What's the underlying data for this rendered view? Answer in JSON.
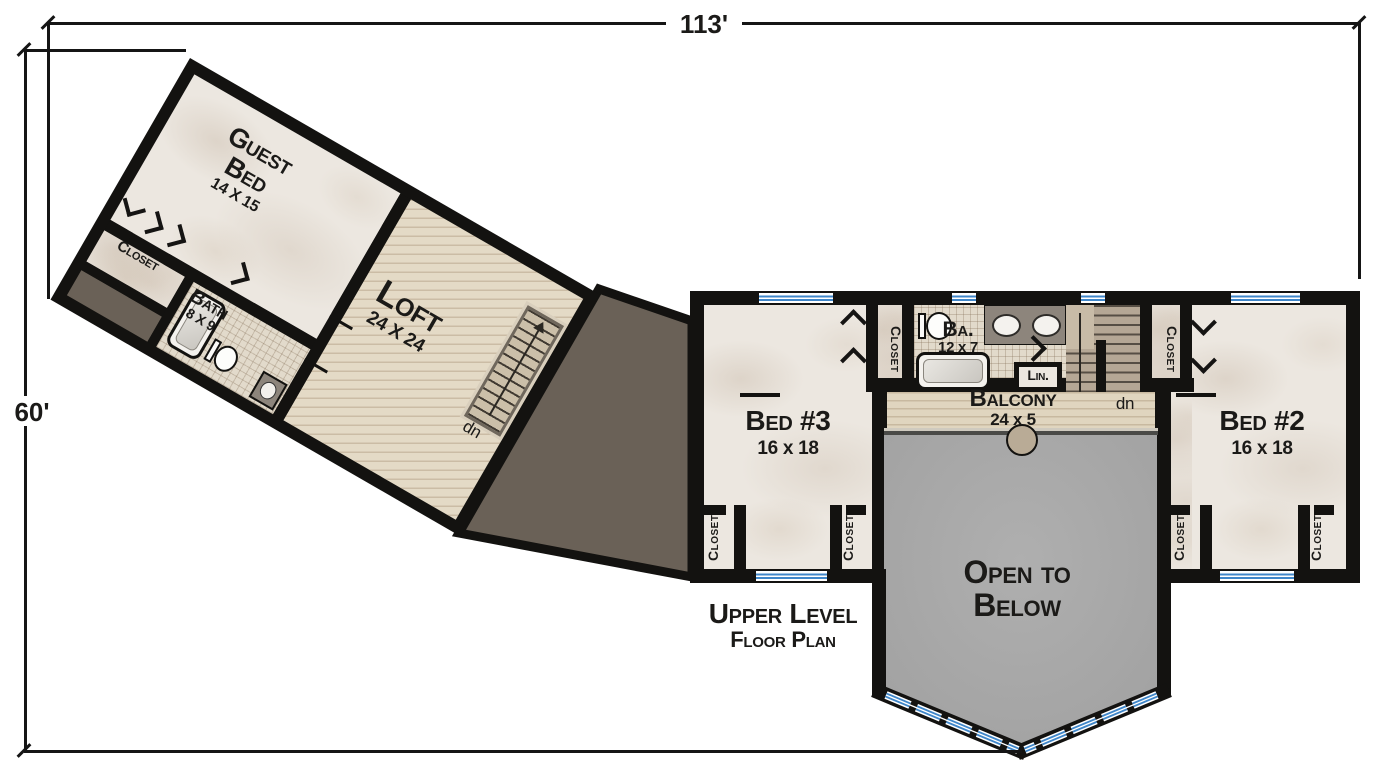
{
  "dimensions": {
    "width": "113'",
    "height": "60'"
  },
  "title": {
    "line1": "Upper Level",
    "line2": "Floor Plan"
  },
  "labels": {
    "closet": "Closet",
    "down": "dn"
  },
  "rooms": {
    "guest_bed": {
      "name1": "Guest",
      "name2": "Bed",
      "size": "14 X 15"
    },
    "loft": {
      "name": "Loft",
      "size": "24 X 24"
    },
    "bath": {
      "name": "Bath",
      "size": "8 X 9"
    },
    "bed3": {
      "name": "Bed #3",
      "size": "16 x 18"
    },
    "bed2": {
      "name": "Bed #2",
      "size": "16 x 18"
    },
    "ba": {
      "name": "Ba.",
      "size": "12 x 7"
    },
    "linen": {
      "name": "Lin."
    },
    "balcony": {
      "name": "Balcony",
      "size": "24 x 5"
    },
    "open_to_below": {
      "line1": "Open to",
      "line2": "Below"
    }
  },
  "colors": {
    "wall": "#131210",
    "floor_cream": "#ece7e0",
    "wood": "#e4dac6",
    "tile": "#e2dacb",
    "roof_dark": "#6a6157",
    "open_below_gray": "#a9a9a9",
    "window_blue": "#3f86c9",
    "stair_taupe": "#b5a795"
  }
}
